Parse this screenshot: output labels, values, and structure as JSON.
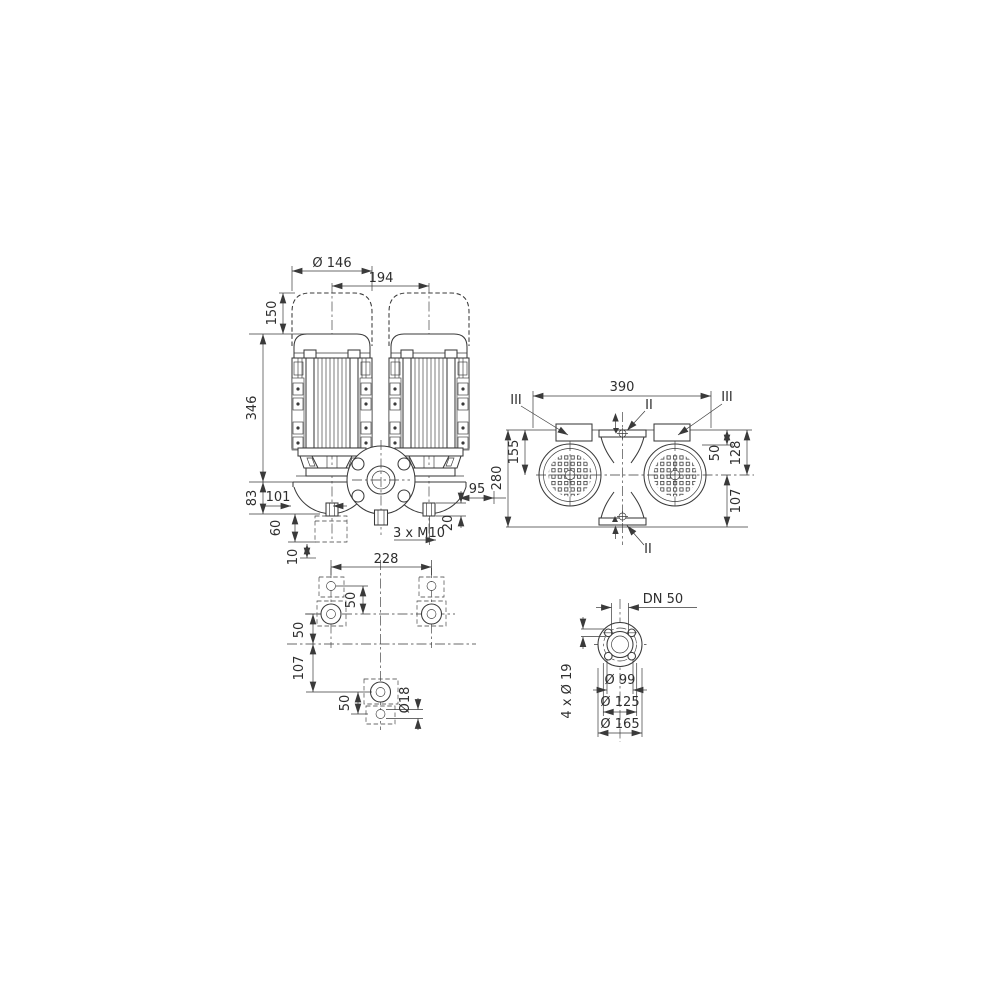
{
  "drawing": {
    "type": "pump dimensional drawing",
    "background": "#ffffff",
    "line_color": "#3a3a3a"
  },
  "views": {
    "front": {
      "dims": {
        "motor_diameter": "Ø 146",
        "motor_spacing": "194",
        "removal_space": "150",
        "motor_height": "346",
        "base_height": "83",
        "left_port_offset": "101",
        "right_edge_offset": "95",
        "foot_height": "60",
        "foot_plate": "10",
        "port_height": "20",
        "tapped_holes": "3 x M10"
      }
    },
    "top": {
      "dims": {
        "overall_length": "390",
        "top_to_motor_center": "155",
        "overall_width": "280",
        "top_to_motor_edge": "50",
        "top_to_axis": "128",
        "axis_to_bottom": "107"
      },
      "sections": {
        "s2": "II",
        "s3": "III"
      }
    },
    "foundation": {
      "dims": {
        "anchor_spacing": "228",
        "pad_hole_pitch": "50",
        "pads_to_axis": "50",
        "axis_to_rear_pad": "107",
        "rear_hole_pitch": "50",
        "hole_diameter": "Ø18"
      }
    },
    "flange": {
      "dims": {
        "nominal": "DN 50",
        "bolt_holes": "4 x Ø 19",
        "hub_diameter": "Ø 99",
        "bolt_circle": "Ø 125",
        "outer_diameter": "Ø 165"
      }
    }
  }
}
